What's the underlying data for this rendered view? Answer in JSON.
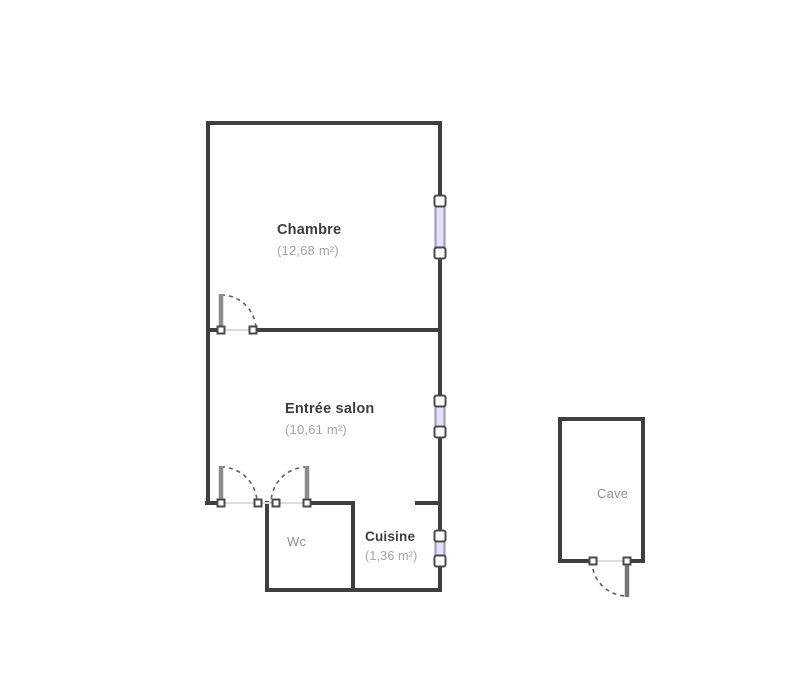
{
  "plan": {
    "type": "apartment-floor-plan",
    "background": "#ffffff",
    "colors": {
      "wall": "#3f3f3f",
      "door_leaf": "#8c8c8c",
      "swing_arc": "#606060",
      "threshold": "#dcdcdc",
      "window_frame": "#9a94cf",
      "window_fill": "#e4e2f3",
      "jamb_square": "#4a4a4a",
      "room_name_text": "#3d3d3d",
      "room_area_text": "#a3a3a3",
      "secondary_text": "#8f8f8f"
    },
    "rooms": [
      {
        "id": "chambre",
        "name": "Chambre",
        "area": "(12,68 m²)"
      },
      {
        "id": "entree-salon",
        "name": "Entrée salon",
        "area": "(10,61 m²)"
      },
      {
        "id": "wc",
        "name": "Wc",
        "area": ""
      },
      {
        "id": "cuisine",
        "name": "Cuisine",
        "area": "(1,36 m²)"
      },
      {
        "id": "cave",
        "name": "Cave",
        "area": ""
      }
    ],
    "features": {
      "windows": 3,
      "single_doors": 2,
      "double_doors": 1
    }
  }
}
